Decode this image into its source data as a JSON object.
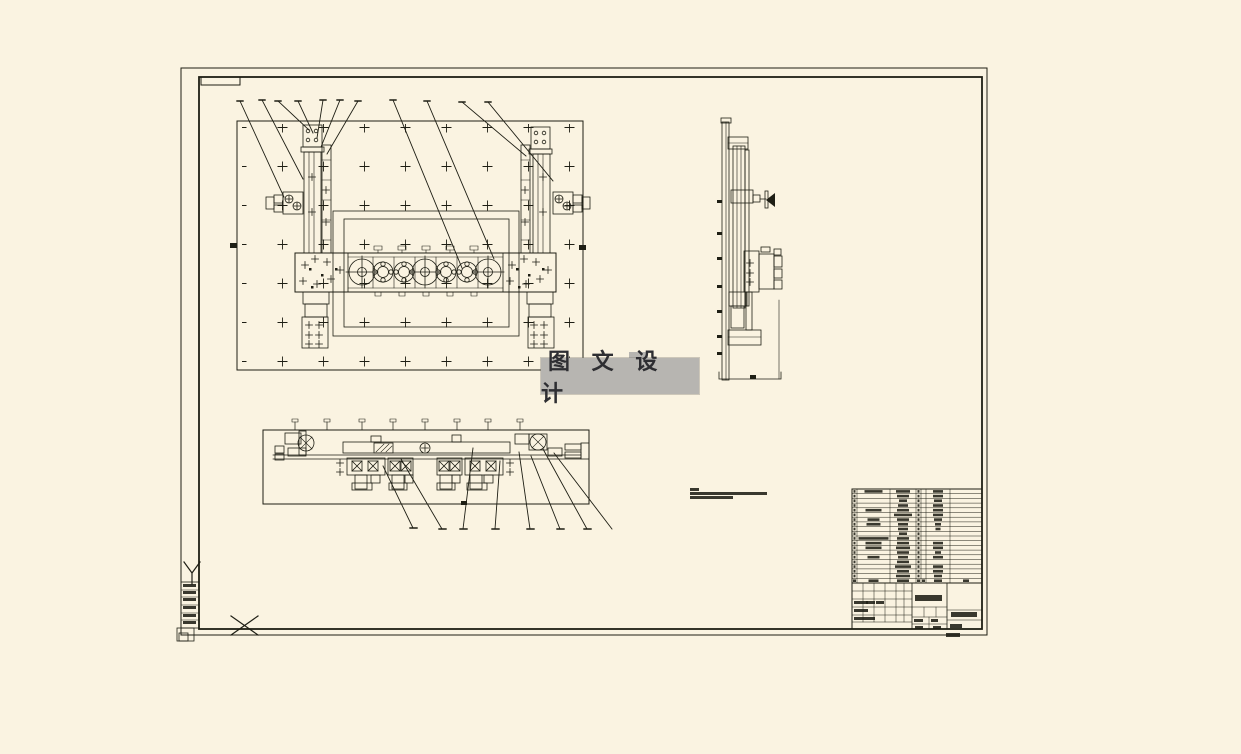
{
  "colors": {
    "paper": "#faf3e1",
    "ink": "#1e1e14",
    "watermark_bg": "#b7b5b1",
    "watermark_fg": "#2e2e32"
  },
  "watermark": {
    "text": "图 文 设 计"
  },
  "notes": {
    "legible": false,
    "line_count": 3
  },
  "title_block": {
    "legible": false
  },
  "bom": {
    "legible": false,
    "columns": [
      {
        "key": "no",
        "w": 5
      },
      {
        "key": "code",
        "w": 33
      },
      {
        "key": "name",
        "w": 26
      },
      {
        "key": "qty",
        "w": 5
      },
      {
        "key": "unit",
        "w": 5
      },
      {
        "key": "material",
        "w": 24
      },
      {
        "key": "remark",
        "w": 32
      }
    ],
    "rows": [
      {
        "c": [
          2,
          18,
          14,
          2,
          0,
          10,
          0
        ]
      },
      {
        "c": [
          2,
          0,
          12,
          2,
          0,
          10,
          0
        ]
      },
      {
        "c": [
          2,
          0,
          8,
          2,
          0,
          8,
          0
        ]
      },
      {
        "c": [
          2,
          0,
          10,
          2,
          0,
          10,
          0
        ]
      },
      {
        "c": [
          2,
          16,
          12,
          2,
          0,
          10,
          0
        ]
      },
      {
        "c": [
          2,
          0,
          18,
          2,
          0,
          10,
          0
        ]
      },
      {
        "c": [
          2,
          12,
          12,
          2,
          0,
          8,
          0
        ]
      },
      {
        "c": [
          2,
          14,
          10,
          2,
          0,
          6,
          0
        ]
      },
      {
        "c": [
          2,
          0,
          10,
          2,
          0,
          5,
          0
        ]
      },
      {
        "c": [
          2,
          0,
          8,
          2,
          0,
          0,
          0
        ]
      },
      {
        "c": [
          2,
          30,
          12,
          2,
          0,
          0,
          0
        ]
      },
      {
        "c": [
          2,
          16,
          12,
          2,
          0,
          10,
          0
        ]
      },
      {
        "c": [
          2,
          16,
          14,
          2,
          0,
          10,
          0
        ]
      },
      {
        "c": [
          2,
          0,
          12,
          2,
          0,
          6,
          0
        ]
      },
      {
        "c": [
          2,
          12,
          10,
          2,
          0,
          10,
          0
        ]
      },
      {
        "c": [
          2,
          0,
          12,
          2,
          0,
          0,
          0
        ]
      },
      {
        "c": [
          2,
          0,
          16,
          2,
          0,
          10,
          0
        ]
      },
      {
        "c": [
          2,
          0,
          12,
          2,
          0,
          10,
          0
        ]
      },
      {
        "c": [
          2,
          0,
          14,
          2,
          0,
          8,
          0
        ]
      },
      {
        "c": [
          3,
          10,
          12,
          3,
          3,
          8,
          6
        ]
      }
    ]
  }
}
